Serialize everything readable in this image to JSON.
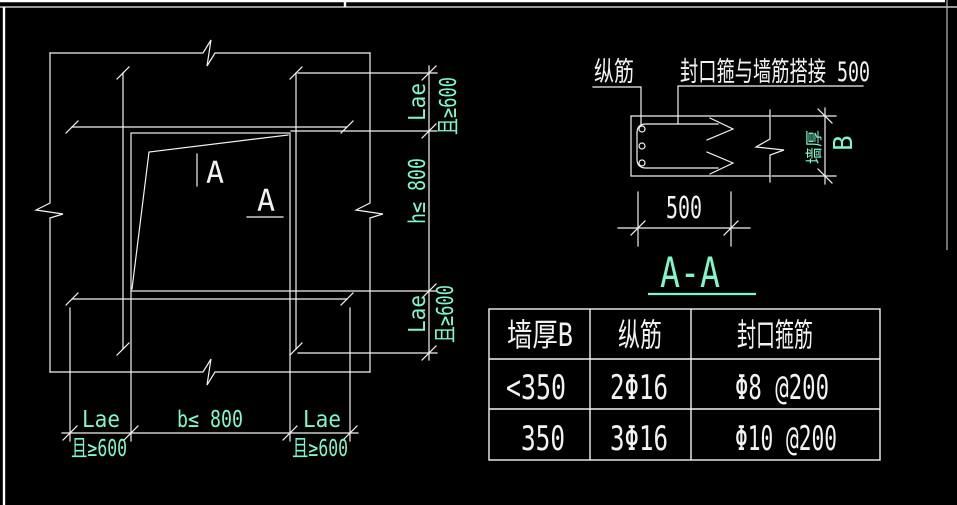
{
  "colors": {
    "background": "#000000",
    "line": "#f2f2f2",
    "dim_text": "#7ef7cf"
  },
  "left_figure": {
    "section_mark_a1": "A",
    "section_mark_a2": "A",
    "dims": {
      "right_top_l1": "Lae",
      "right_top_l2": "且≥600",
      "right_mid": "h≤ 800",
      "right_bot_l1": "Lae",
      "right_bot_l2": "且≥600",
      "bottom_left_l1": "Lae",
      "bottom_left_l2": "且≥600",
      "bottom_mid": "b≤ 800",
      "bottom_right_l1": "Lae",
      "bottom_right_l2": "且≥600"
    }
  },
  "right_figure": {
    "label_longitudinal_bar": "纵筋",
    "label_closing_stirrup_lap": "封口箍与墙筋搭接 500",
    "dim_lap_length": "500",
    "dim_wall_thickness_label": "墙厚",
    "dim_wall_thickness_symbol": "B"
  },
  "section_title": "A-A",
  "table": {
    "headers": [
      "墙厚B",
      "纵筋",
      "封口箍筋"
    ],
    "rows": [
      [
        "<350",
        "2Φ16",
        "Φ8 @200"
      ],
      [
        "350",
        "3Φ16",
        "Φ10 @200"
      ]
    ]
  }
}
